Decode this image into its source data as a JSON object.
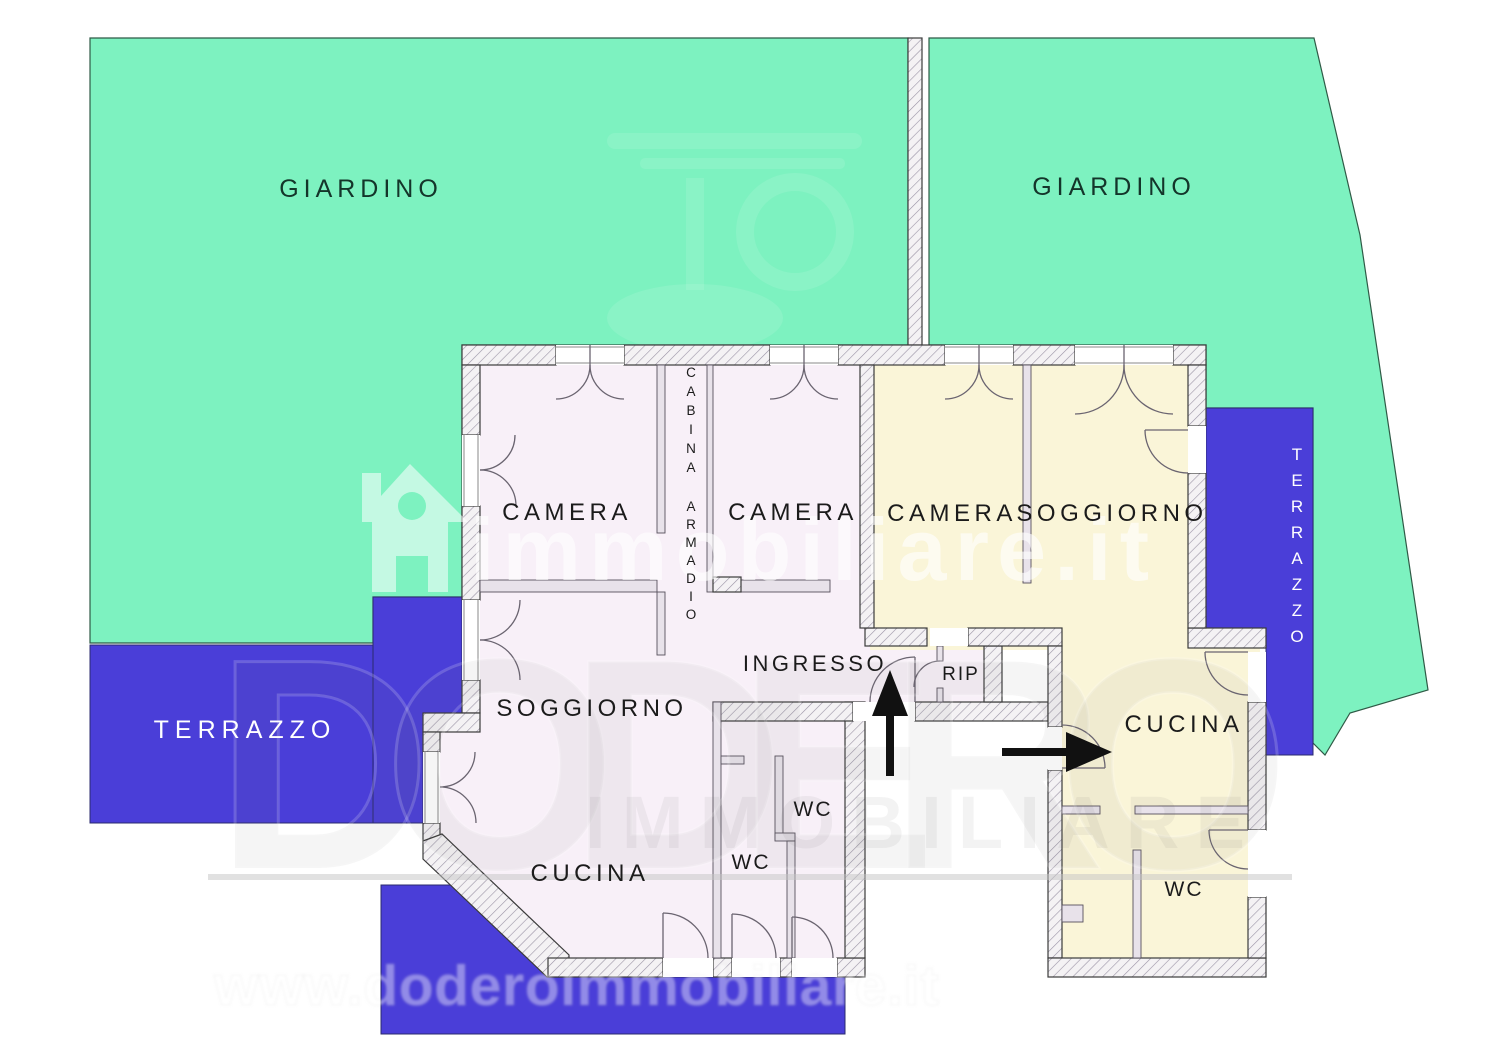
{
  "labels": {
    "garden_left": "GIARDINO",
    "garden_right": "GIARDINO",
    "terrace_left": "TERRAZZO",
    "terrace_right": "TERRAZZO",
    "camera_1": "CAMERA",
    "camera_2": "CAMERA",
    "camera_3": "CAMERA",
    "soggiorno_left": "SOGGIORNO",
    "soggiorno_right": "SOGGIORNO",
    "cucina_left": "CUCINA",
    "cucina_right": "CUCINA",
    "ingresso": "INGRESSO",
    "ripostiglio": "RIP",
    "wc_left_upper": "WC",
    "wc_left_lower": "WC",
    "wc_right": "WC",
    "closet_line1": "CABINA",
    "closet_line2": "ARMADIO"
  },
  "watermark": {
    "brand": "immobiliare.it",
    "agency": "DODERO",
    "agency_word2": "IMMOBILIARE",
    "url": "www.doderoimmobiliare.it"
  },
  "colors": {
    "garden": "#7DF2C0",
    "terrace": "#4A3ED8",
    "apartment_left_fill": "#F8F0F8",
    "apartment_right_fill": "#FAF5D8",
    "wall_outline": "#3B3B3B",
    "room_label": "#1B1B1B",
    "garden_label": "#14352A",
    "terrace_label": "#FFFFFF",
    "arrow": "#111111"
  }
}
